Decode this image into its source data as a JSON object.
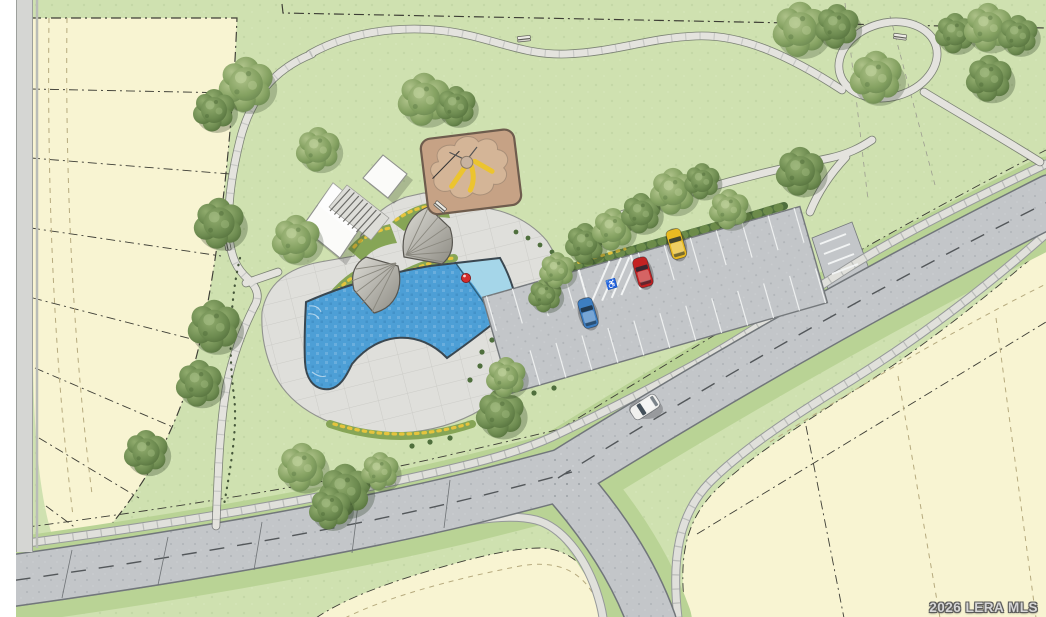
{
  "watermark": "2026 LERA MLS",
  "icons": {
    "wheelchair": "♿"
  },
  "scene": {
    "type": "site-plan-rendering",
    "features": [
      "swimming-pool",
      "splash-pad",
      "pool-deck",
      "amenity-building",
      "stairs",
      "shade-ramada",
      "playground-sand-pit",
      "play-structure",
      "parking-lot",
      "accessible-parking",
      "walking-paths",
      "walking-loop",
      "street-intersection",
      "vacant-residential-lots",
      "trees",
      "planting-beds",
      "benches",
      "pool-fence"
    ]
  },
  "cars": {
    "parked": [
      "blue",
      "red",
      "yellow"
    ],
    "on_street": [
      "white"
    ]
  },
  "colors": {
    "margin": "#ffffff",
    "grass": "#cfe1b0",
    "verge": "#b9d395",
    "parcel": "#f8f4d2",
    "road": "#c3c6c9",
    "roadedge": "#71767a",
    "sidewalk": "#e0e0db",
    "sidewalkedge": "#96999a",
    "path": "#e4e3de",
    "pathedge": "#5f6160",
    "pooldeck": "#dfdfdb",
    "poolwater": "#4d9fd6",
    "poolshallow": "#a5d6e9",
    "pooledge": "#3a4750",
    "playbase": "#c6a285",
    "playsand": "#d4b597",
    "playedge": "#6e5c4d",
    "playequip": "#ecc42f",
    "building": "#fbfbf9",
    "buildingedge": "#8f918d",
    "canopyedge": "#57554f",
    "bed": "#86a556",
    "flower": "#e5c43d",
    "shrub": "#4f6f3d",
    "carblue": "#3d7ec2",
    "carred": "#c32222",
    "caryellow": "#e9ba22",
    "carwhite": "#f1f1ef",
    "ball": "#d32c2c",
    "linedark": "#3d3d35",
    "linetan": "#b6aa7e",
    "fence": "#46573b"
  }
}
